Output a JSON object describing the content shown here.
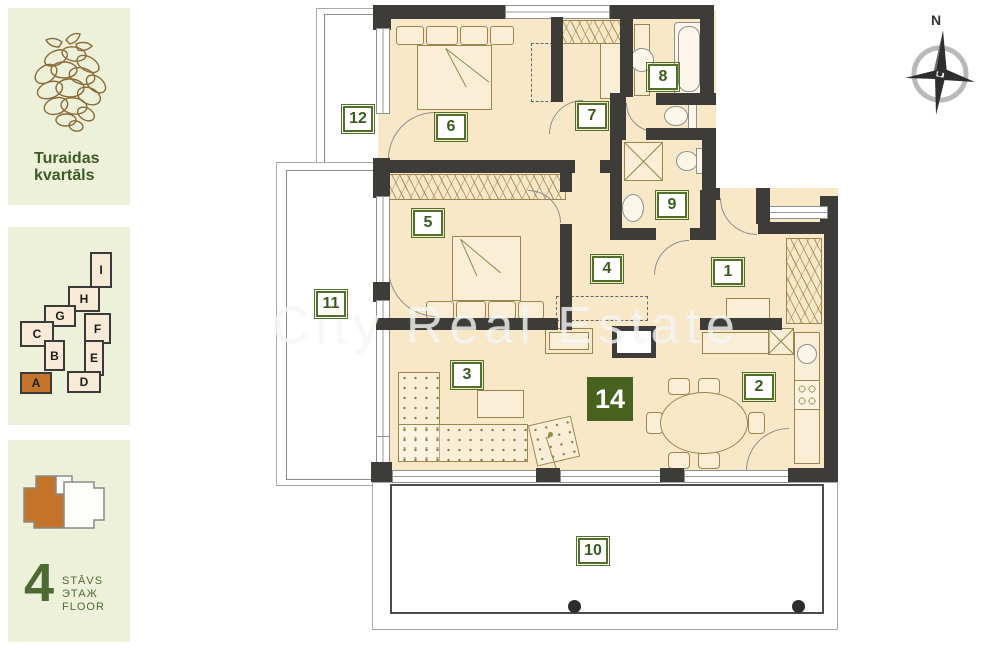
{
  "branding": {
    "project_line1": "Turaidas",
    "project_line2": "kvartāls",
    "logo": "pinecone-icon"
  },
  "site_map": {
    "buildings": [
      {
        "label": "I",
        "active": false
      },
      {
        "label": "H",
        "active": false
      },
      {
        "label": "G",
        "active": false
      },
      {
        "label": "C",
        "active": false
      },
      {
        "label": "B",
        "active": false
      },
      {
        "label": "F",
        "active": false
      },
      {
        "label": "E",
        "active": false
      },
      {
        "label": "D",
        "active": false
      },
      {
        "label": "A",
        "active": true
      }
    ]
  },
  "floor_indicator": {
    "number": "4",
    "levels": [
      "STĀVS",
      "ЭТАЖ",
      "FLOOR"
    ]
  },
  "floor_plan": {
    "apartment_badge": "14",
    "room_labels": [
      "1",
      "2",
      "3",
      "4",
      "5",
      "6",
      "7",
      "8",
      "9",
      "10",
      "11",
      "12"
    ],
    "compass_label": "N",
    "watermark": "City Real Estate",
    "colors": {
      "room_fill": "#f8e8c7",
      "wall": "#3e3c39",
      "badge_green": "#51702c",
      "apartment_badge_bg": "#46621c",
      "accent_orange": "#c4732b",
      "sidebar_bg": "#edf1d9",
      "sidebar_text": "#3c5b26"
    }
  }
}
